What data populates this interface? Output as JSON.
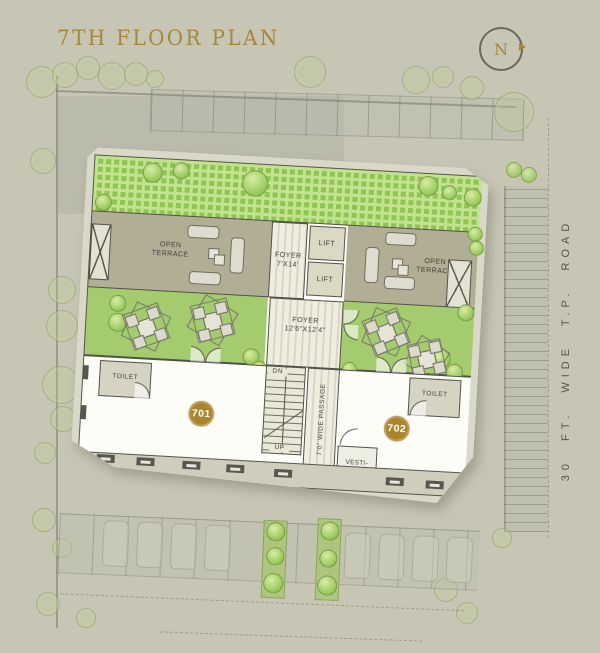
{
  "title": "7TH FLOOR PLAN",
  "north": {
    "label": "N"
  },
  "road": {
    "label": "30 FT. WIDE T.P. ROAD"
  },
  "plan": {
    "terrace_left": {
      "line1": "OPEN",
      "line2": "TERRACE"
    },
    "terrace_right": {
      "line1": "OPEN",
      "line2": "TERRACE"
    },
    "foyer_upper": {
      "line1": "FOYER",
      "line2": "7'X14'"
    },
    "lift_upper": "LIFT",
    "lift_lower": "LIFT",
    "duct_left": "FHC",
    "duct_right": "ELEC",
    "foyer_mid": {
      "line1": "FOYER",
      "line2": "12'6\"X12'4\""
    },
    "stairs": {
      "down": "DN",
      "up": "UP"
    },
    "passage": "7'0\" WIDE PASSAGE",
    "vestibule": {
      "line1": "VESTI-",
      "line2": "BULE"
    },
    "toilet_left": "TOILET",
    "toilet_right": "TOILET",
    "unit_left": "701",
    "unit_right": "702"
  },
  "colors": {
    "background": "#c7c6b4",
    "accent_gold": "#a5873c",
    "badge_gold": "#a9852e",
    "lawn_green": "#a4cb6d",
    "grass_dark": "#8fc455",
    "terrace_tan": "#b2ae96",
    "wall_dark": "#52524a"
  }
}
